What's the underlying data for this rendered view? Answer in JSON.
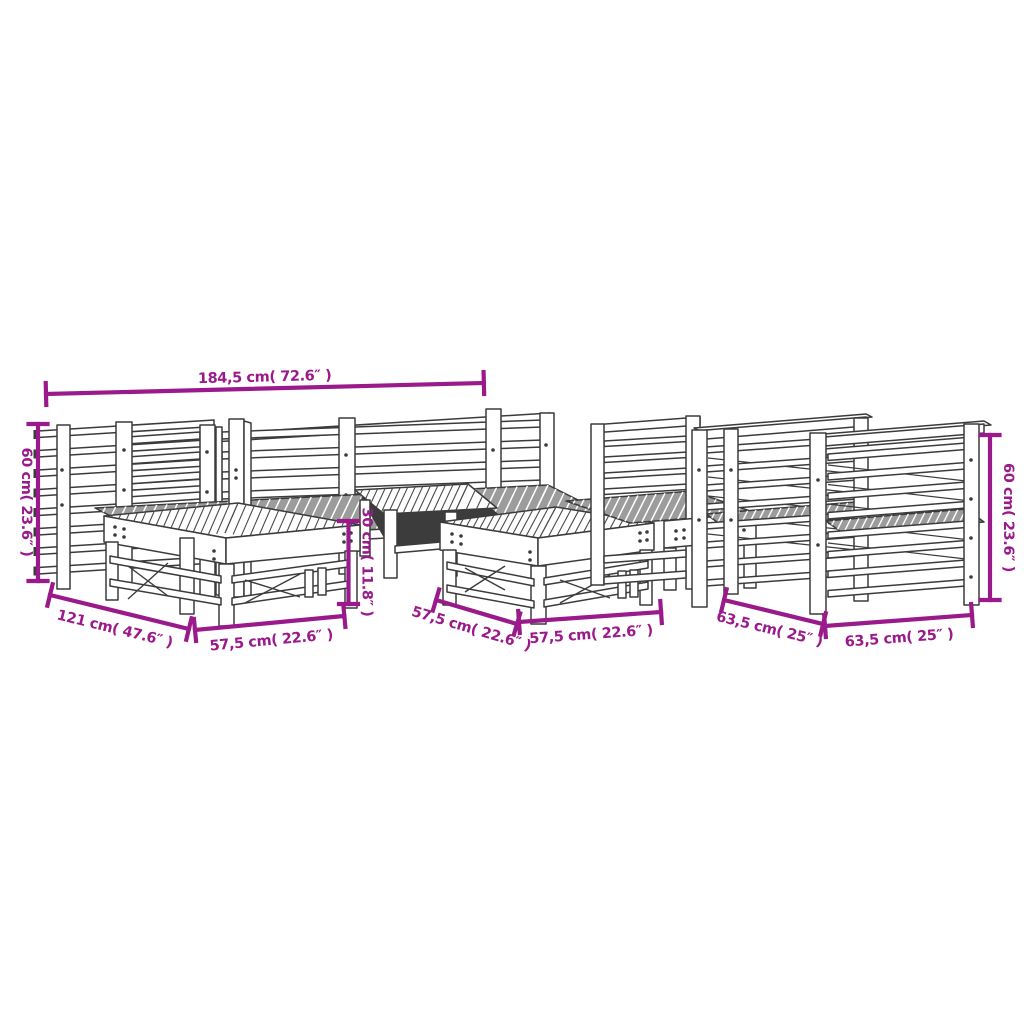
{
  "figure": {
    "description": "Line drawing of a 7-piece wooden garden lounge furniture set (corner sofa sections with slatted backs, slatted footstools / tables and slatted armchairs) annotated with magenta dimension arrows",
    "background": "#FFFFFF"
  },
  "colors": {
    "dimension_accent": "#9A1A8B",
    "line_art": "#3B3B3B",
    "seat_fill": "#9C9C9C"
  },
  "dimensions": [
    {
      "id": "overall-width",
      "text": "184,5 cm( 72.6″ )",
      "cm": "184,5",
      "inch": "72.6",
      "orientation": "horizontal",
      "location": "top"
    },
    {
      "id": "seat-height-left",
      "text": "60 cm( 23.6″ )",
      "cm": "60",
      "inch": "23.6",
      "orientation": "vertical",
      "location": "left"
    },
    {
      "id": "sofa-depth",
      "text": "121 cm( 47.6″ )",
      "cm": "121",
      "inch": "47.6",
      "orientation": "diagonal",
      "location": "bottom-left"
    },
    {
      "id": "footstool-width",
      "text": "57,5 cm( 22.6″ )",
      "cm": "57,5",
      "inch": "22.6",
      "orientation": "horizontal",
      "location": "bottom-left-2"
    },
    {
      "id": "footstool-height",
      "text": "30 cm( 11.8″ )",
      "cm": "30",
      "inch": "11.8",
      "orientation": "vertical",
      "location": "middle"
    },
    {
      "id": "footstool-depth",
      "text": "57,5 cm( 22.6″ )",
      "cm": "57,5",
      "inch": "22.6",
      "orientation": "diagonal",
      "location": "bottom-middle-1"
    },
    {
      "id": "footstool-width-2",
      "text": "57,5 cm( 22.6″ )",
      "cm": "57,5",
      "inch": "22.6",
      "orientation": "horizontal",
      "location": "bottom-middle-2"
    },
    {
      "id": "chair-depth",
      "text": "63,5 cm( 25″ )",
      "cm": "63,5",
      "inch": "25",
      "orientation": "diagonal",
      "location": "bottom-right-1"
    },
    {
      "id": "chair-width",
      "text": "63,5 cm( 25″ )",
      "cm": "63,5",
      "inch": "25",
      "orientation": "horizontal",
      "location": "bottom-right-2"
    },
    {
      "id": "seat-height-right",
      "text": "60 cm( 23.6″ )",
      "cm": "60",
      "inch": "23.6",
      "orientation": "vertical",
      "location": "right"
    }
  ]
}
